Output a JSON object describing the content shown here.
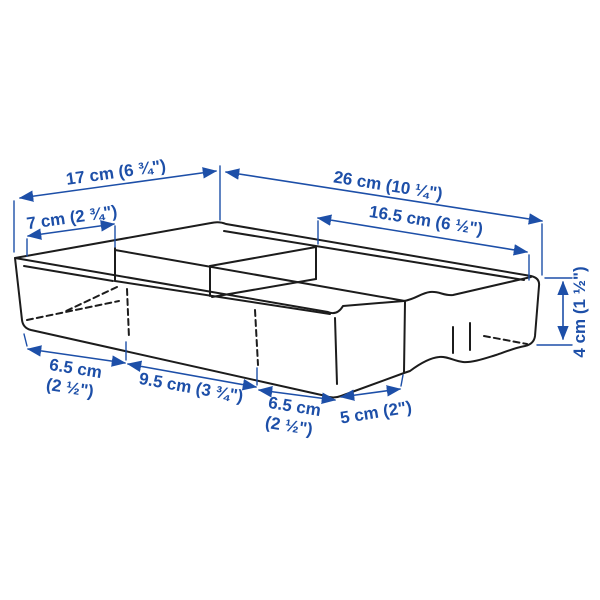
{
  "diagram": {
    "type": "product-dimensions",
    "subject": "drawer organizer tray with compartments",
    "accent_color": "#1d4fa8",
    "line_color": "#1c1c1c",
    "background_color": "#ffffff",
    "dimensions": {
      "width_left_top": "17 cm (6 ¾\")",
      "width_right_top": "26 cm (10 ¼\")",
      "inner_left": "7 cm (2 ¾\")",
      "inner_right": "16.5 cm (6 ½\")",
      "height": "4 cm (1 ½\")",
      "front_first": "6.5 cm\n(2 ½\")",
      "front_second": "9.5 cm (3 ¾\")",
      "front_third": "6.5 cm\n(2 ½\")",
      "front_fourth": "5 cm (2\")"
    }
  }
}
